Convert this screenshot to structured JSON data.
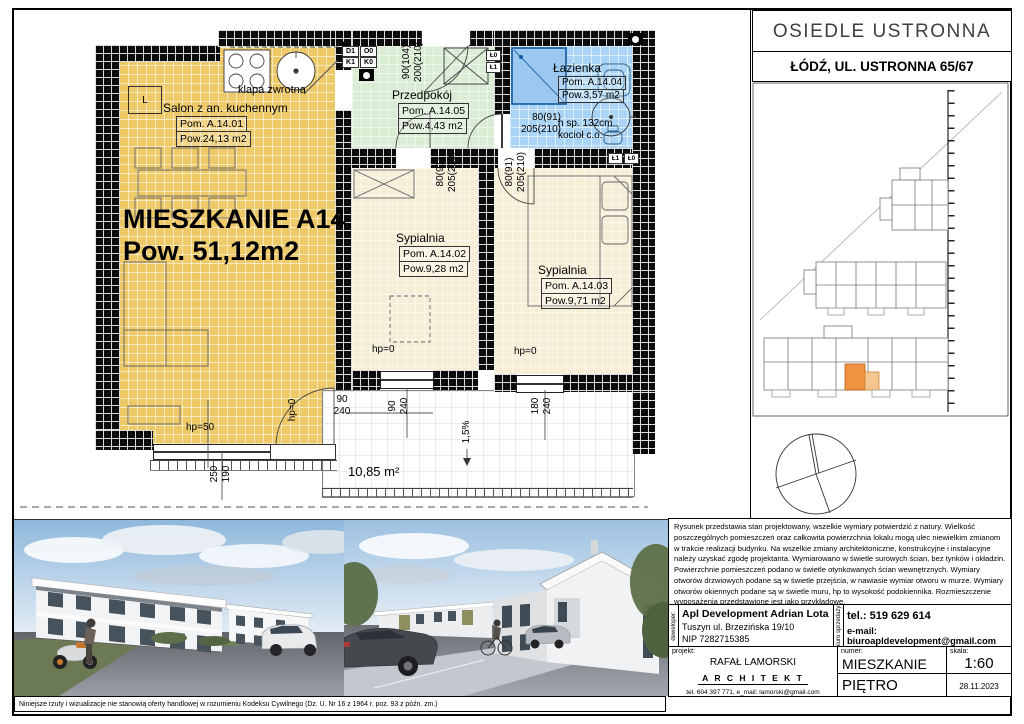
{
  "header": {
    "estate": "OSIEDLE USTRONNA",
    "address": "ŁÓDŹ, UL. USTRONNA 65/67"
  },
  "apartment": {
    "title": "MIESZKANIE A14",
    "area": "Pow. 51,12m2"
  },
  "rooms": {
    "salon": {
      "name": "Salon z an. kuchennym",
      "id": "Pom. A.14.01",
      "area": "Pow.24,13 m2"
    },
    "syp1": {
      "name": "Sypialnia",
      "id": "Pom. A.14.02",
      "area": "Pow.9,28 m2"
    },
    "syp2": {
      "name": "Sypialnia",
      "id": "Pom. A.14.03",
      "area": "Pow.9,71 m2"
    },
    "bath": {
      "name": "Łazienka",
      "id": "Pom. A.14.04",
      "area": "Pow.3,57 m2"
    },
    "hall": {
      "name": "Przedpokój",
      "id": "Pom. A.14.05",
      "area": "Pow.4,43 m2"
    }
  },
  "ann": {
    "klapa": "klapa zwrotna",
    "boiler1": "h sp. 132cm",
    "boiler2": "kocioł c.o.",
    "terrace": "10,85 m²",
    "slope": "1,5%",
    "l": "L"
  },
  "dims": {
    "entry_w": "90(104)",
    "entry_h": "200(210)",
    "door_w": "80(91)",
    "door_h": "205(210)",
    "hp0": "hp=0",
    "hp50": "hp=50",
    "n90": "90",
    "n240": "240",
    "n180": "180",
    "n250": "250",
    "n190": "190"
  },
  "codes": {
    "d1": "D1",
    "o0": "O0",
    "k1": "K1",
    "k0": "K0",
    "L1": "Ł1",
    "L0": "Ł0"
  },
  "colors": {
    "salon": "#eec968",
    "hall": "#d9ecd4",
    "bath": "#aad4f5",
    "bedroom": "#f6eed6",
    "highlight": "#ef9340"
  },
  "tb": {
    "disclaimer": "Rysunek przedstawia stan projektowany, wszelkie wymiary potwierdzić z natury. Wielkość poszczególnych pomieszczeń oraz całkowita powierzchnia lokalu mogą ulec niewielkim zmianom w trakcie realizacji budynku. Na wszelkie zmiany architektoniczne, konstrukcyjne i instalacyjne należy uzyskać zgodę projektanta. Wymiarowano w świetle surowych ścian, bez tynków i okładzin. Powierzchnie pomieszczeń podano w świetle otynkowanych ścian wewnętrznych. Wymiary otworów drzwiowych podane są w świetle przejścia, w nawiasie wymiar otworu w murze. Wymiary otworów okiennych podane są w świetle muru, hp to wysokość podokiennika. Rozmieszczenie wyposażenia przedstawione jest jako przykładowe.",
    "dev_label": "deweloper:",
    "dev_name": "Apl Development Adrian Lota",
    "dev_addr": "Tuszyn ul. Brzezińska 19/10",
    "dev_nip": "NIP 7282715385",
    "office_label": "biuro sprzedaży:",
    "tel": "tel.: 519 629 614",
    "email": "e-mail: biuroapldevelopment@gmail.com",
    "projekt_label": "projekt:",
    "arch_name": "RAFAŁ LAMORSKI",
    "arch_title": "A R C H I T E K T",
    "arch_contact": "tel.  604 397 771,      e_mail: lamorski@gmail.com",
    "numer_label": "numer:",
    "numer": "MIESZKANIE  A14",
    "skala_label": "skala:",
    "skala": "1:60",
    "floor": "PIĘTRO",
    "date": "28.11.2023"
  },
  "legal": "Niniejsze rzuty i wizualizacje nie stanowią oferty handlowej w rozumieniu Kodeksu Cywilnego (Dz. U. Nr 16 z 1964 r. poz. 93 z późn. zm.)"
}
